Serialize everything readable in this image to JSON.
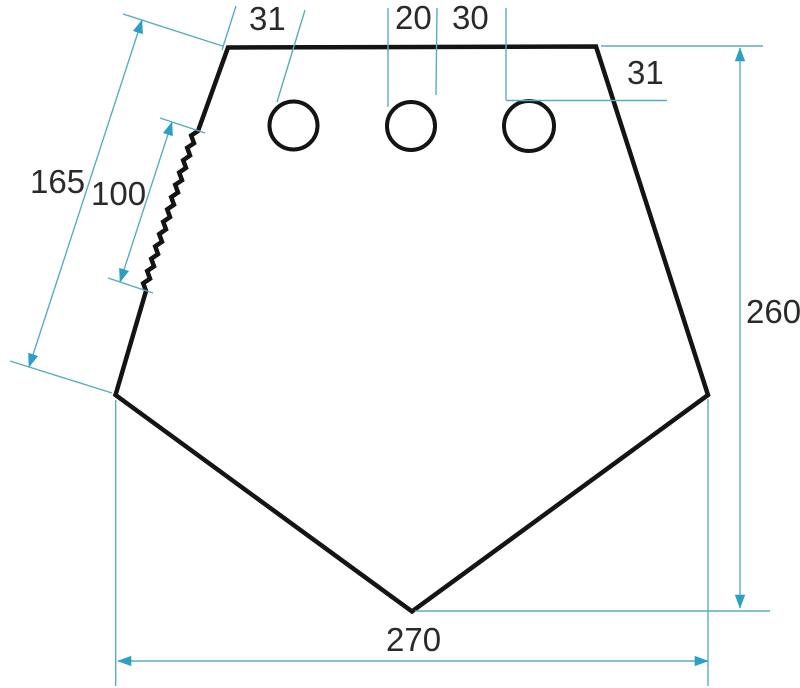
{
  "drawing": {
    "type": "technical-dimension-drawing",
    "labels": {
      "offset_top_left": "31",
      "hole_diameter": "20",
      "hole_spacing": "30",
      "offset_top_right": "31",
      "edge_length": "165",
      "serration_length": "100",
      "overall_height": "260",
      "overall_width": "270"
    },
    "colors": {
      "outline": "#141414",
      "dimension_line": "#57adc2",
      "arrow": "#2b9fc4",
      "label_text": "#2a2a2a"
    }
  }
}
